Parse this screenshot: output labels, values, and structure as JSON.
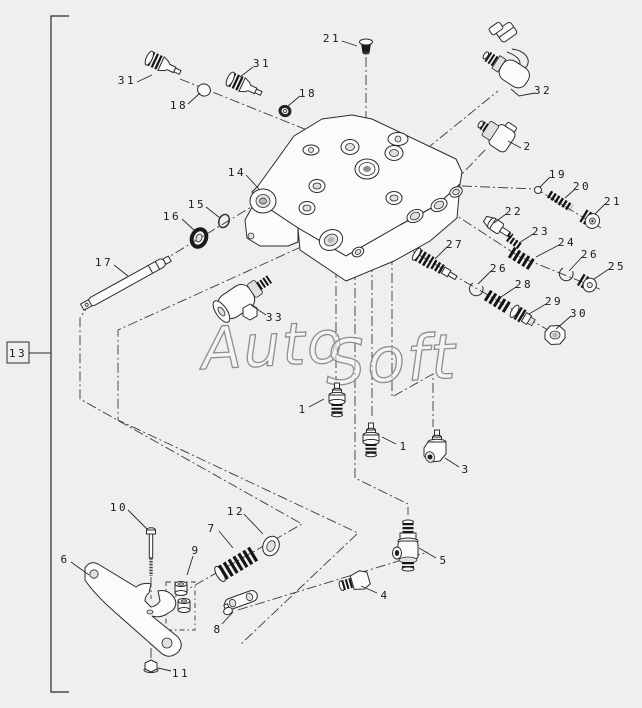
{
  "diagram": {
    "type": "exploded-parts-diagram",
    "colors": {
      "background": "#efefef",
      "line": "#2b2b2b",
      "watermark": "#8f8f8f"
    },
    "watermark": {
      "text": "AutoSoft",
      "part1": "Auto",
      "part2": "Soft"
    },
    "assembly": {
      "ref_label": "13"
    },
    "callouts": [
      {
        "n": "31",
        "x": 127,
        "y": 80,
        "l": [
          [
            137,
            82
          ],
          [
            152,
            75
          ]
        ]
      },
      {
        "n": "18",
        "x": 179,
        "y": 105,
        "l": [
          [
            188,
            104
          ],
          [
            200,
            93
          ]
        ]
      },
      {
        "n": "31",
        "x": 262,
        "y": 63,
        "l": [
          [
            253,
            67
          ],
          [
            240,
            77
          ]
        ]
      },
      {
        "n": "18",
        "x": 308,
        "y": 93,
        "l": [
          [
            300,
            96
          ],
          [
            288,
            106
          ]
        ]
      },
      {
        "n": "21",
        "x": 332,
        "y": 38,
        "l": [
          [
            342,
            41
          ],
          [
            357,
            46
          ]
        ]
      },
      {
        "n": "32",
        "x": 543,
        "y": 90,
        "l": [
          [
            535,
            93
          ],
          [
            519,
            96
          ],
          [
            511,
            89
          ]
        ]
      },
      {
        "n": "2",
        "x": 528,
        "y": 146,
        "l": [
          [
            521,
            148
          ],
          [
            508,
            141
          ]
        ]
      },
      {
        "n": "19",
        "x": 558,
        "y": 174,
        "l": [
          [
            550,
            177
          ],
          [
            540,
            187
          ]
        ]
      },
      {
        "n": "20",
        "x": 582,
        "y": 186,
        "l": [
          [
            574,
            190
          ],
          [
            565,
            198
          ]
        ]
      },
      {
        "n": "21",
        "x": 613,
        "y": 201,
        "l": [
          [
            605,
            204
          ],
          [
            595,
            214
          ]
        ]
      },
      {
        "n": "22",
        "x": 514,
        "y": 211,
        "l": [
          [
            506,
            214
          ],
          [
            494,
            223
          ]
        ]
      },
      {
        "n": "23",
        "x": 541,
        "y": 231,
        "l": [
          [
            533,
            234
          ],
          [
            519,
            243
          ]
        ]
      },
      {
        "n": "24",
        "x": 567,
        "y": 242,
        "l": [
          [
            559,
            245
          ],
          [
            536,
            257
          ]
        ]
      },
      {
        "n": "26",
        "x": 590,
        "y": 254,
        "l": [
          [
            582,
            257
          ],
          [
            569,
            271
          ]
        ]
      },
      {
        "n": "25",
        "x": 617,
        "y": 266,
        "l": [
          [
            609,
            269
          ],
          [
            594,
            279
          ]
        ]
      },
      {
        "n": "27",
        "x": 455,
        "y": 244,
        "l": [
          [
            447,
            247
          ],
          [
            435,
            259
          ]
        ]
      },
      {
        "n": "26",
        "x": 499,
        "y": 268,
        "l": [
          [
            491,
            271
          ],
          [
            478,
            284
          ]
        ]
      },
      {
        "n": "28",
        "x": 524,
        "y": 284,
        "l": [
          [
            516,
            287
          ],
          [
            501,
            297
          ]
        ]
      },
      {
        "n": "29",
        "x": 554,
        "y": 301,
        "l": [
          [
            546,
            304
          ],
          [
            529,
            314
          ]
        ]
      },
      {
        "n": "30",
        "x": 579,
        "y": 313,
        "l": [
          [
            571,
            316
          ],
          [
            556,
            329
          ]
        ]
      },
      {
        "n": "14",
        "x": 237,
        "y": 172,
        "l": [
          [
            246,
            175
          ],
          [
            259,
            189
          ]
        ]
      },
      {
        "n": "15",
        "x": 197,
        "y": 204,
        "l": [
          [
            206,
            207
          ],
          [
            220,
            218
          ]
        ]
      },
      {
        "n": "16",
        "x": 172,
        "y": 216,
        "l": [
          [
            182,
            219
          ],
          [
            195,
            231
          ]
        ]
      },
      {
        "n": "17",
        "x": 104,
        "y": 262,
        "l": [
          [
            114,
            265
          ],
          [
            128,
            276
          ]
        ]
      },
      {
        "n": "33",
        "x": 275,
        "y": 317,
        "l": [
          [
            266,
            315
          ],
          [
            251,
            305
          ]
        ]
      },
      {
        "n": "1",
        "x": 303,
        "y": 409,
        "l": [
          [
            309,
            407
          ],
          [
            324,
            399
          ]
        ]
      },
      {
        "n": "1",
        "x": 404,
        "y": 446,
        "l": [
          [
            396,
            444
          ],
          [
            382,
            437
          ]
        ]
      },
      {
        "n": "3",
        "x": 466,
        "y": 469,
        "l": [
          [
            459,
            467
          ],
          [
            445,
            458
          ]
        ]
      },
      {
        "n": "5",
        "x": 444,
        "y": 560,
        "l": [
          [
            436,
            558
          ],
          [
            419,
            548
          ]
        ]
      },
      {
        "n": "4",
        "x": 385,
        "y": 595,
        "l": [
          [
            377,
            593
          ],
          [
            361,
            586
          ]
        ]
      },
      {
        "n": "6",
        "x": 65,
        "y": 559,
        "l": [
          [
            71,
            562
          ],
          [
            89,
            575
          ]
        ]
      },
      {
        "n": "10",
        "x": 119,
        "y": 507,
        "l": [
          [
            128,
            510
          ],
          [
            147,
            529
          ]
        ]
      },
      {
        "n": "12",
        "x": 236,
        "y": 511,
        "l": [
          [
            244,
            514
          ],
          [
            263,
            534
          ]
        ]
      },
      {
        "n": "7",
        "x": 212,
        "y": 528,
        "l": [
          [
            219,
            531
          ],
          [
            233,
            548
          ]
        ]
      },
      {
        "n": "9",
        "x": 196,
        "y": 550,
        "l": [
          [
            193,
            556
          ],
          [
            187,
            575
          ]
        ]
      },
      {
        "n": "8",
        "x": 218,
        "y": 629,
        "l": [
          [
            222,
            624
          ],
          [
            233,
            612
          ]
        ]
      },
      {
        "n": "11",
        "x": 181,
        "y": 673,
        "l": [
          [
            171,
            671
          ],
          [
            158,
            668
          ]
        ]
      }
    ],
    "axes": [
      [
        [
          180,
          79
        ],
        [
          322,
          136
        ]
      ],
      [
        [
          366,
          57
        ],
        [
          366,
          176
        ]
      ],
      [
        [
          398,
          172
        ],
        [
          498,
          91
        ]
      ],
      [
        [
          441,
          196
        ],
        [
          486,
          149
        ]
      ],
      [
        [
          462,
          186
        ],
        [
          536,
          189
        ],
        [
          601,
          228
        ]
      ],
      [
        [
          448,
          210
        ],
        [
          520,
          257
        ],
        [
          602,
          290
        ]
      ],
      [
        [
          402,
          245
        ],
        [
          560,
          337
        ]
      ],
      [
        [
          261,
          201
        ],
        [
          88,
          306
        ],
        [
          80,
          318
        ],
        [
          80,
          399
        ],
        [
          302,
          524
        ],
        [
          148,
          612
        ]
      ],
      [
        [
          334,
          232
        ],
        [
          118,
          330
        ],
        [
          118,
          420
        ],
        [
          358,
          533
        ],
        [
          240,
          645
        ]
      ],
      [
        [
          238,
          610
        ],
        [
          428,
          552
        ]
      ],
      [
        [
          336,
          268
        ],
        [
          336,
          381
        ]
      ],
      [
        [
          372,
          262
        ],
        [
          372,
          419
        ]
      ],
      [
        [
          392,
          255
        ],
        [
          392,
          397
        ],
        [
          433,
          374
        ],
        [
          433,
          427
        ]
      ],
      [
        [
          355,
          270
        ],
        [
          355,
          478
        ],
        [
          408,
          504
        ],
        [
          408,
          515
        ]
      ],
      [
        [
          151,
          577
        ],
        [
          151,
          599
        ]
      ],
      [
        [
          151,
          630
        ],
        [
          151,
          661
        ]
      ]
    ],
    "bushing_box": [
      166,
      582,
      29,
      48
    ],
    "bracket": {
      "x": 51,
      "y1": 16,
      "y2": 692,
      "tick": 18,
      "box": [
        7,
        342,
        22,
        21
      ],
      "link": [
        [
          29,
          353
        ],
        [
          51,
          353
        ]
      ]
    }
  }
}
